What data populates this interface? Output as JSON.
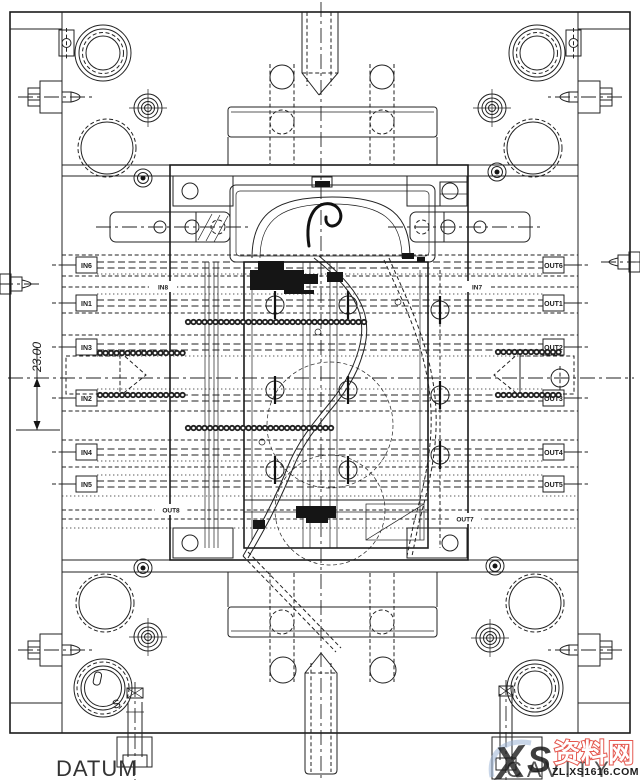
{
  "drawing": {
    "dimension_label": "23.00",
    "datum_label": "DATUM",
    "cavity_label": "CAVITY",
    "date_stamp_s": "S"
  },
  "cooling": {
    "left_ports": [
      "IN6",
      "IN1",
      "IN3",
      "IN2",
      "IN4",
      "IN5"
    ],
    "right_ports": [
      "OUT6",
      "OUT1",
      "OUT2",
      "OUT3",
      "OUT4",
      "OUT5"
    ],
    "inner_left_upper": "IN8",
    "inner_right_upper": "IN7",
    "inner_left_lower": "OUT8",
    "inner_right_lower": "OUT7"
  },
  "watermark": {
    "logo_x": "X",
    "logo_s": "S",
    "site_name": "资料网",
    "site_url": "ZL.XS1616.COM"
  },
  "colors": {
    "line": "#222222",
    "watermark_red": "#e4574e",
    "watermark_blue": "#8ea9cf",
    "watermark_orange": "#f5a93b",
    "watermark_gray": "#9a9a9a"
  }
}
